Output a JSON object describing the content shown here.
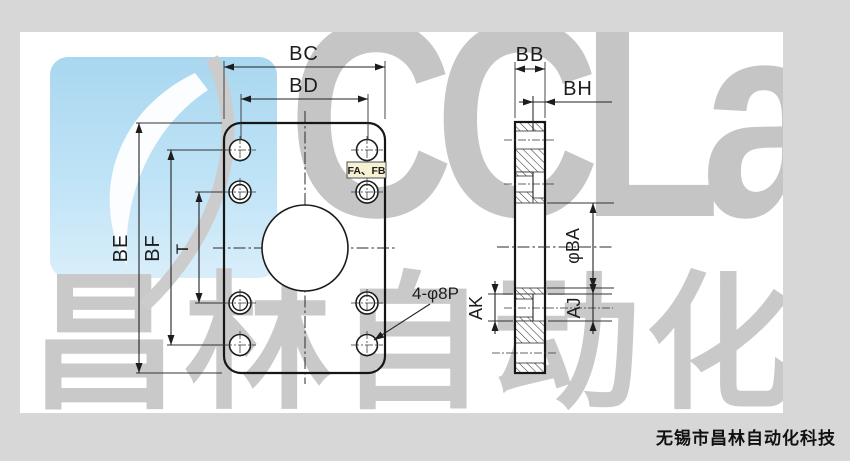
{
  "watermark": {
    "brand": "CCLair",
    "brand_cn": "昌林自动化"
  },
  "footer": {
    "company": "无锡市昌林自动化科技"
  },
  "drawing": {
    "front_view": {
      "dim_width_outer": "BC",
      "dim_width_holes": "BD",
      "dim_height_outer": "BE",
      "dim_height_holes": "BF",
      "dim_height_inner": "T",
      "holes_note": "4-φ8P",
      "ports_label": "FA、FB"
    },
    "side_view": {
      "dim_thickness": "BB",
      "dim_boss": "BH",
      "dim_bore": "φBA",
      "dim_counterbore_right": "AJ",
      "dim_counterbore_left": "AK"
    }
  },
  "colors": {
    "logo_blue": "#a9d7f0",
    "watermark_gray": "#c6c6c6",
    "line_dark": "#1d1d1d",
    "label_box_bg": "#f6f1d3",
    "page_bg": "#ffffff",
    "margin_bg": "#d7d7d7"
  }
}
